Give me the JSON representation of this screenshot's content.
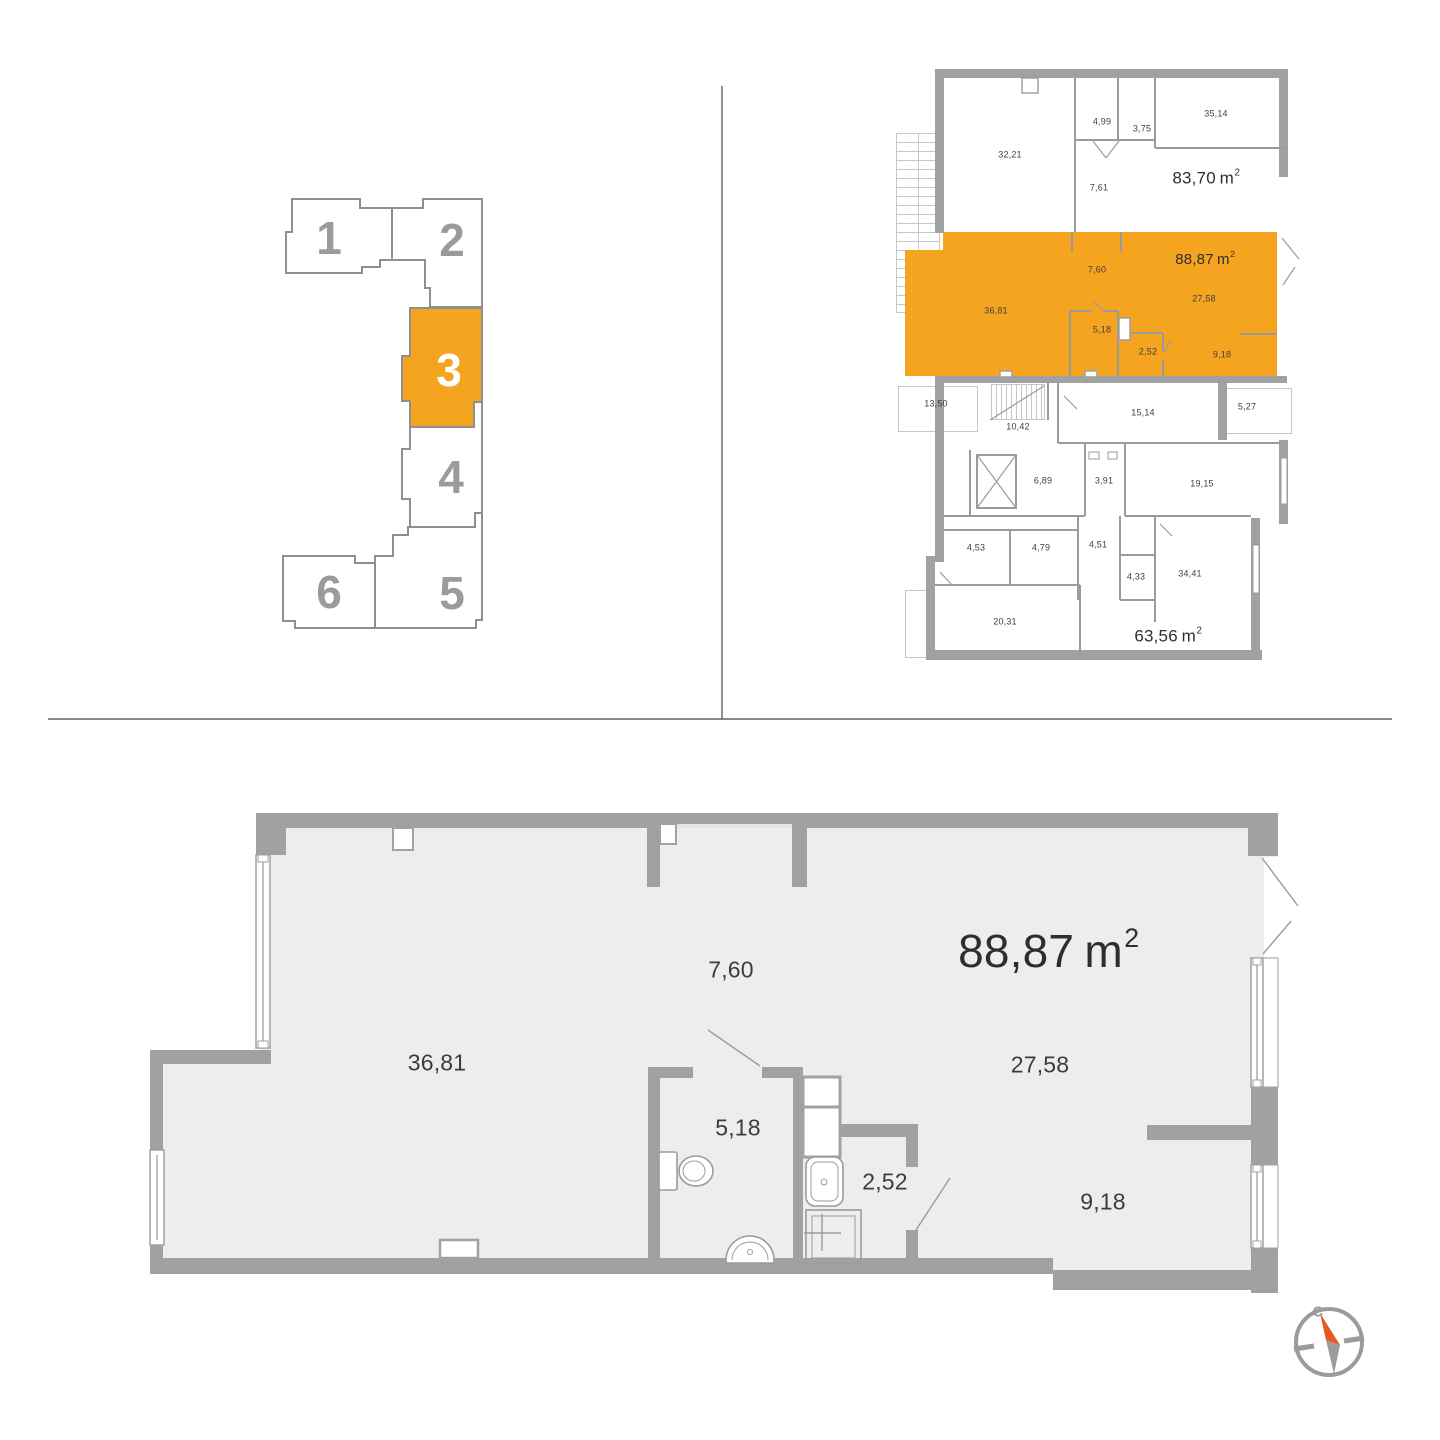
{
  "scheme": {
    "units": [
      "1",
      "2",
      "3",
      "4",
      "5",
      "6"
    ],
    "selected_unit": "3"
  },
  "overview": {
    "apartment_top": {
      "area": "83,70",
      "unit": "m",
      "sup": "2",
      "rooms": [
        "32,21",
        "4,99",
        "3,75",
        "7,61",
        "35,14"
      ]
    },
    "apartment_selected": {
      "area": "88,87",
      "unit": "m",
      "sup": "2",
      "rooms": [
        "7,60",
        "36,81",
        "27,58",
        "5,18",
        "2,52",
        "9,18"
      ]
    },
    "apartment_bottom": {
      "area": "63,56",
      "unit": "m",
      "sup": "2",
      "rooms": [
        "13,50",
        "10,42",
        "15,14",
        "5,27",
        "6,89",
        "3,91",
        "19,15",
        "4,53",
        "4,79",
        "4,51",
        "4,33",
        "34,41",
        "20,31"
      ]
    }
  },
  "detail": {
    "area": "88,87",
    "unit": "m",
    "sup": "2",
    "rooms": [
      "7,60",
      "36,81",
      "27,58",
      "5,18",
      "2,52",
      "9,18"
    ]
  },
  "compass": {
    "north": "С"
  },
  "colors": {
    "accent": "#F5A41F",
    "wall": "#A0A1A3",
    "floor": "#EDEDED",
    "line": "#9B9B9B",
    "compass_needle": "#E8581E"
  }
}
